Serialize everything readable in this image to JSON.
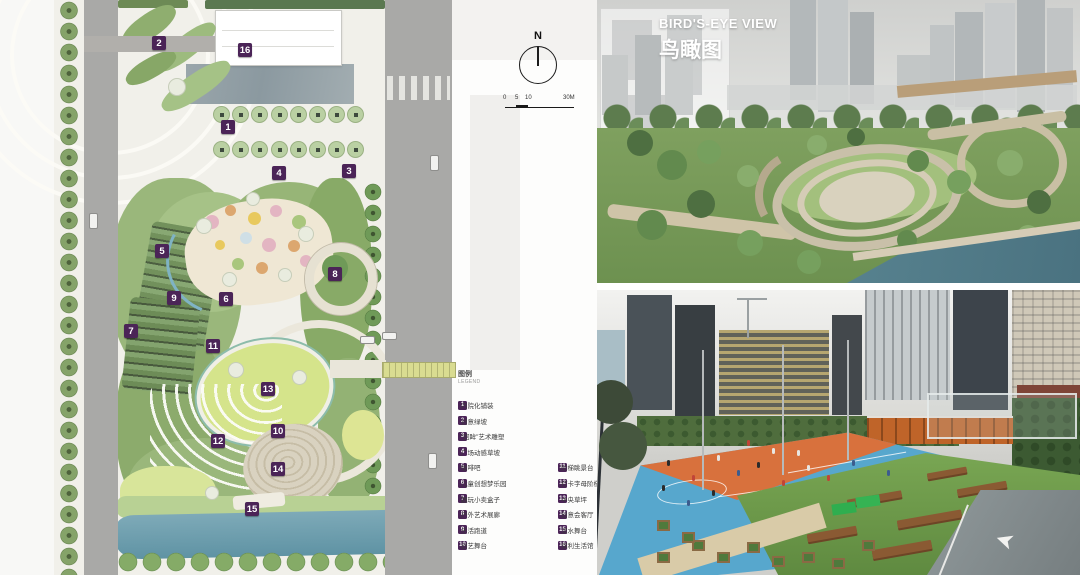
{
  "site_plan": {
    "markers": [
      {
        "num": "1",
        "x": 228,
        "y": 127
      },
      {
        "num": "2",
        "x": 159,
        "y": 43
      },
      {
        "num": "3",
        "x": 349,
        "y": 171
      },
      {
        "num": "4",
        "x": 279,
        "y": 173
      },
      {
        "num": "5",
        "x": 162,
        "y": 251
      },
      {
        "num": "6",
        "x": 226,
        "y": 299
      },
      {
        "num": "7",
        "x": 131,
        "y": 331
      },
      {
        "num": "8",
        "x": 335,
        "y": 274
      },
      {
        "num": "9",
        "x": 174,
        "y": 298
      },
      {
        "num": "10",
        "x": 278,
        "y": 431
      },
      {
        "num": "11",
        "x": 213,
        "y": 346
      },
      {
        "num": "12",
        "x": 218,
        "y": 441
      },
      {
        "num": "13",
        "x": 268,
        "y": 389
      },
      {
        "num": "14",
        "x": 278,
        "y": 469
      },
      {
        "num": "15",
        "x": 252,
        "y": 509
      },
      {
        "num": "16",
        "x": 245,
        "y": 50
      }
    ],
    "tree_grid": {
      "rows": 2,
      "cols": 8,
      "x0": 213,
      "y0": 106,
      "dx": 19.2,
      "dy": 35,
      "size": 17
    }
  },
  "compass": {
    "label": "N"
  },
  "scale_bar": {
    "ticks": [
      "0",
      "5",
      "10",
      "30M"
    ]
  },
  "legend": {
    "title": "图例",
    "subtitle": "LEGEND",
    "items": [
      {
        "num": "1",
        "label": "内院化铺装"
      },
      {
        "num": "2",
        "label": "创意绿坡"
      },
      {
        "num": "3",
        "label": "“回眸”艺术雕塑"
      },
      {
        "num": "4",
        "label": "广场动感草坡"
      },
      {
        "num": "5",
        "label": "咖啡吧"
      },
      {
        "num": "6",
        "label": "儿童创想梦乐园"
      },
      {
        "num": "7",
        "label": "趣玩小卖盒子"
      },
      {
        "num": "8",
        "label": "户外艺术展廊"
      },
      {
        "num": "9",
        "label": "乐活跑道"
      },
      {
        "num": "10",
        "label": "创艺舞台"
      },
      {
        "num": "11",
        "label": "阶梯眺景台"
      },
      {
        "num": "12",
        "label": "打卡字母阶梯"
      },
      {
        "num": "13",
        "label": "中央草坪"
      },
      {
        "num": "14",
        "label": "创意会客厅"
      },
      {
        "num": "15",
        "label": "滨水舞台"
      },
      {
        "num": "16",
        "label": "保利生活馆"
      }
    ]
  },
  "birdseye": {
    "title_en": "BIRD'S-EYE VIEW",
    "title_zh": "鸟瞰图"
  },
  "colors": {
    "accent_purple": "#4b2457",
    "court_blue": "#57a7cd",
    "court_orange": "#d8713d",
    "turf_green": "#6f9e4d",
    "river_blue": "#6fa0b0",
    "lawn_green": "#d5e48b"
  }
}
